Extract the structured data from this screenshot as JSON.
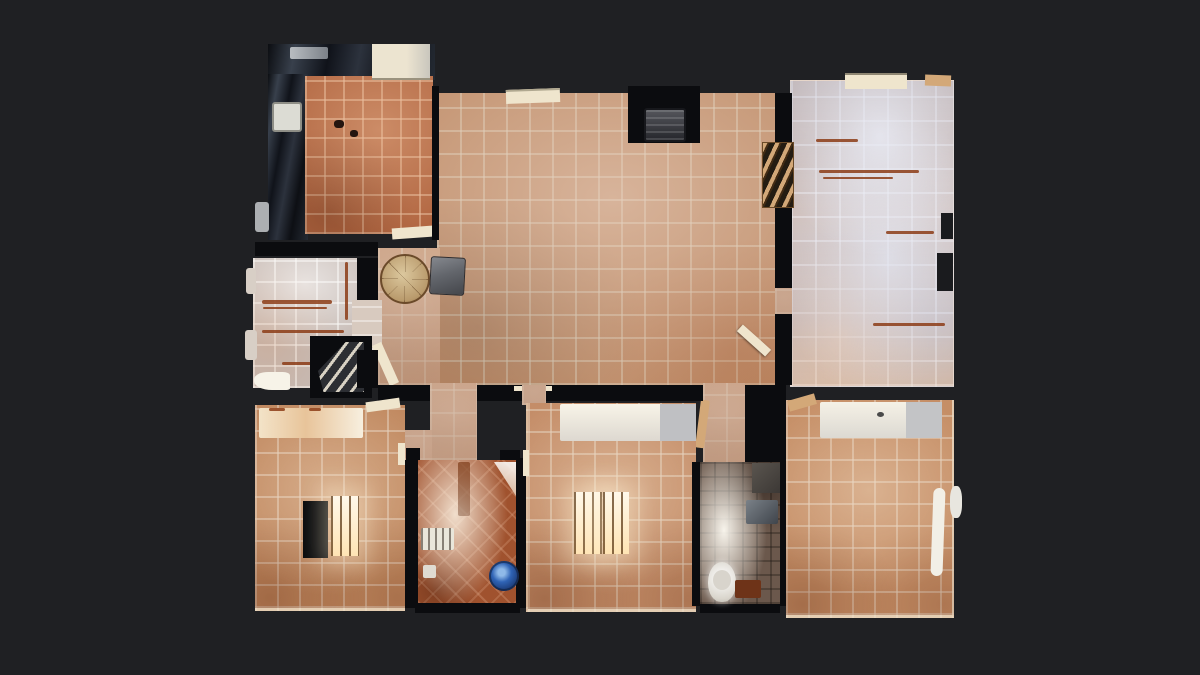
{
  "app": {
    "name": "3d-home-tour-viewer",
    "view_mode": "top-down floor plan (dollhouse scan)",
    "visible_text": "none"
  },
  "palette": {
    "bg": "#1f2023",
    "bg2": "#1a1b1e",
    "wall": "#0b0c0f",
    "tile-hall": "#bf8d69",
    "tile-kitchen": "#b26742",
    "tile-dining": "#c6bab4",
    "tile-topright": "#c8b3a9",
    "tile-bed-left": "#c0885f",
    "tile-bed-mid": "#c48d68",
    "tile-bed-right": "#c58e66",
    "tile-laundry": "#a0522e",
    "tile-bath": "#6b584c",
    "counter-dark": "#14171d",
    "cream": "#efe5cd",
    "white-warm": "#f7f3e8",
    "window-glow": "#ffedc4",
    "bucket-blue": "#2f63b5",
    "streak-brown": "#8c3c16",
    "stair-dark": "#2c2e33",
    "step-light": "#d8d2c4",
    "table-wood": "#c3a87e",
    "chair-gray": "#63666c",
    "fireplace-gray": "#43454b",
    "door-tan": "#d3a878"
  },
  "rooms": [
    {
      "id": "kitchen",
      "position": "top-left",
      "floor": "orange terracotta tile",
      "features": [
        "dark-glossy-countertops-L",
        "white-sink",
        "white-cabinet",
        "doorway-threshold"
      ]
    },
    {
      "id": "living-hall",
      "position": "center",
      "floor": "sandy terracotta tile",
      "features": [
        "fireplace-nook",
        "round-wood-table",
        "gray-chair",
        "open-door",
        "wall-vent"
      ]
    },
    {
      "id": "dining-room",
      "position": "mid-left",
      "floor": "pale washed tile",
      "features": [
        "shelf-streaks",
        "staircase-down",
        "open-door",
        "vestibule-doorway"
      ]
    },
    {
      "id": "bedroom-top-right",
      "position": "top-right",
      "floor": "pale blue-pink washed tile",
      "features": [
        "louvered-door",
        "window-ledge",
        "furniture-streaks",
        "wall-notches"
      ]
    },
    {
      "id": "bedroom-bottom-left",
      "position": "bottom-left",
      "floor": "terracotta tile",
      "features": [
        "bright-bed-band",
        "scan-hole-black-rect",
        "barred-window-glow"
      ]
    },
    {
      "id": "laundry-room",
      "position": "bottom-center-left",
      "floor": "red-orange diagonal tile",
      "features": [
        "skylight-bright-column",
        "white-shelf-ladder",
        "blue-bucket",
        "detergent-box"
      ]
    },
    {
      "id": "bedroom-bottom-middle",
      "position": "bottom-center",
      "floor": "terracotta tile",
      "features": [
        "white-wardrobe-band",
        "double-barred-window-glow"
      ]
    },
    {
      "id": "bathroom",
      "position": "bottom-right-center",
      "floor": "dark taupe tile",
      "features": [
        "ceiling-light-blob",
        "toilet",
        "bath-mat",
        "gray-shelf"
      ]
    },
    {
      "id": "bedroom-bottom-right",
      "position": "bottom-right",
      "floor": "terracotta tile",
      "features": [
        "white-bed-band",
        "white-door-leaf"
      ]
    }
  ],
  "corridors": [
    {
      "id": "corridor-left",
      "connects": [
        "living-hall",
        "laundry-room",
        "bedroom-bottom-left"
      ]
    },
    {
      "id": "corridor-right",
      "connects": [
        "living-hall",
        "bathroom"
      ]
    }
  ]
}
